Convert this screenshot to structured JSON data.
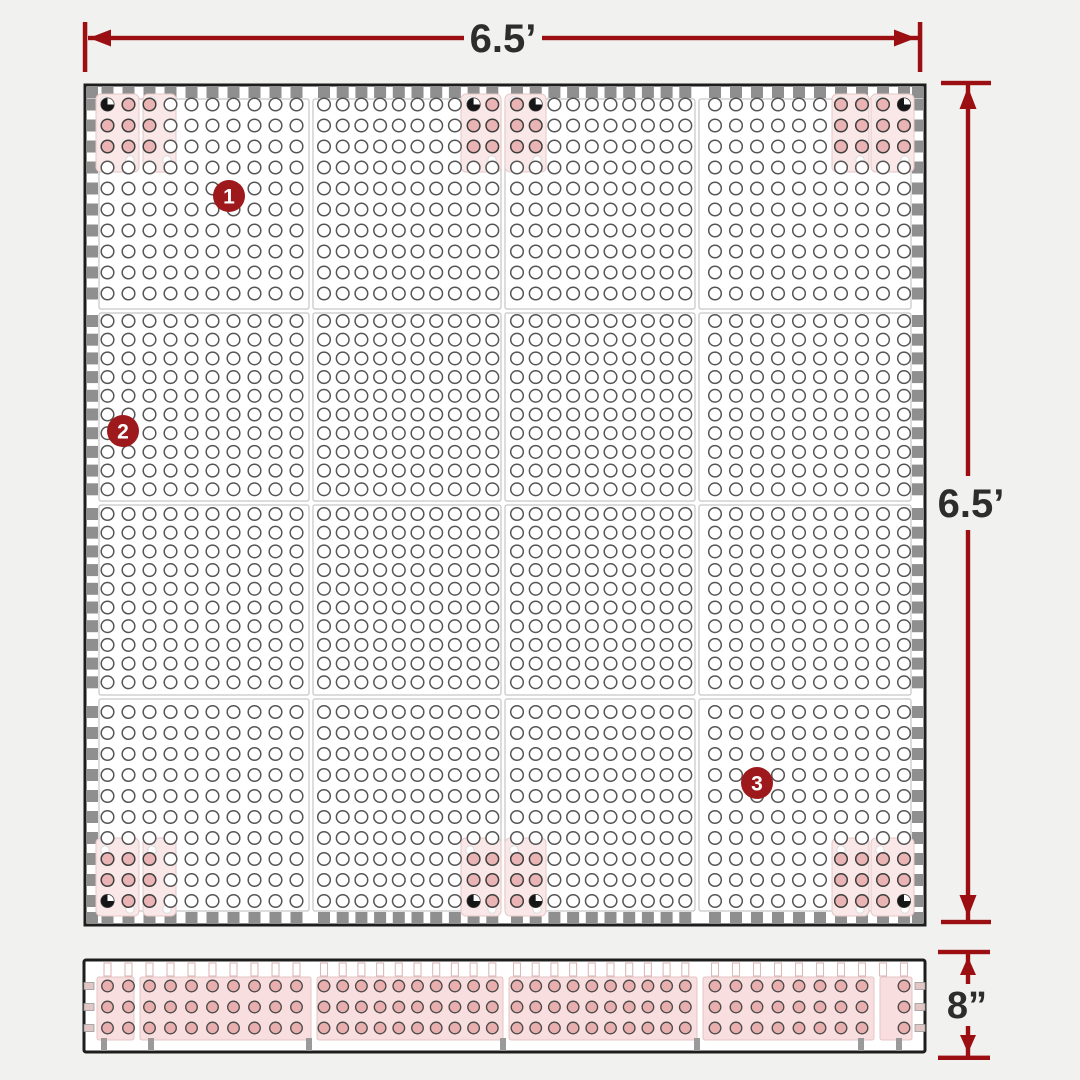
{
  "diagram": {
    "title": "pegboard-panel-dimension-diagram",
    "dimensions": {
      "width": {
        "label": "6.5’"
      },
      "height": {
        "label": "6.5’"
      },
      "depth": {
        "label": "8”"
      }
    },
    "markers": [
      {
        "number": "1",
        "x": 229,
        "y": 196
      },
      {
        "number": "2",
        "x": 123,
        "y": 431
      },
      {
        "number": "3",
        "x": 757,
        "y": 783
      }
    ],
    "board": {
      "panel_cols": 4,
      "panel_rows": 4,
      "holes_per_panel_row": 10,
      "holes_per_panel_col": 10,
      "mounting_plate_pairs": 6
    },
    "colors": {
      "background": "#f1f1ef",
      "accent_red": "#9b0f12",
      "marker_red": "#9e191c",
      "label_dark": "#2d2d2d",
      "board_border": "#1d1d1d",
      "teeth_gray": "#8f8f8f",
      "hole_stroke": "#555555",
      "subpanel_stroke": "#c6c6c6",
      "plate_fill": "#fae8e8",
      "plate_stroke": "#e7c9c9",
      "plate_hole_fill": "#eab4b4",
      "plate_hole_stroke": "#3e3e3e",
      "strip_section_fill": "#f8dede",
      "strip_section_stroke": "#e4c4c4",
      "strip_hole_fill": "#e9aeae",
      "strip_hole_stroke": "#4a4a4a",
      "foot_gray": "#9a9a9a",
      "screw_black": "#161616"
    }
  }
}
